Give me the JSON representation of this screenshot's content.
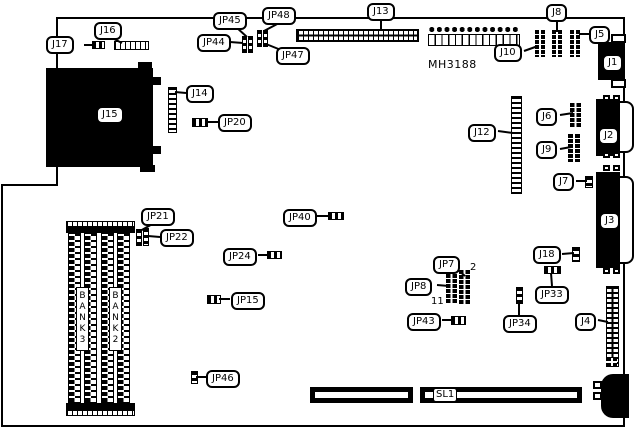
{
  "board": {
    "part_number": "MH3188",
    "banks": {
      "bank3": "BANK 3",
      "bank2": "BANK 2"
    },
    "pin_annotations": {
      "jp7_top": "2",
      "jp8_bottom": "11"
    }
  },
  "callouts": {
    "j17": "J17",
    "j16": "J16",
    "jp45": "JP45",
    "jp48": "JP48",
    "jp44": "JP44",
    "jp47": "JP47",
    "j13": "J13",
    "j8": "J8",
    "j5": "J5",
    "j10": "J10",
    "j1": "J1",
    "j15": "J15",
    "j14": "J14",
    "jp20": "JP20",
    "j12": "J12",
    "j6": "J6",
    "j9": "J9",
    "j2": "J2",
    "j7": "J7",
    "j3": "J3",
    "jp21": "JP21",
    "jp22": "JP22",
    "jp40": "JP40",
    "jp24": "JP24",
    "jp7": "JP7",
    "jp8": "JP8",
    "j18": "J18",
    "jp33": "JP33",
    "jp15": "JP15",
    "jp43": "JP43",
    "jp34": "JP34",
    "j4": "J4",
    "jp46": "JP46",
    "sl1": "SL1"
  },
  "colors": {
    "line": "#000000",
    "background": "#ffffff"
  }
}
